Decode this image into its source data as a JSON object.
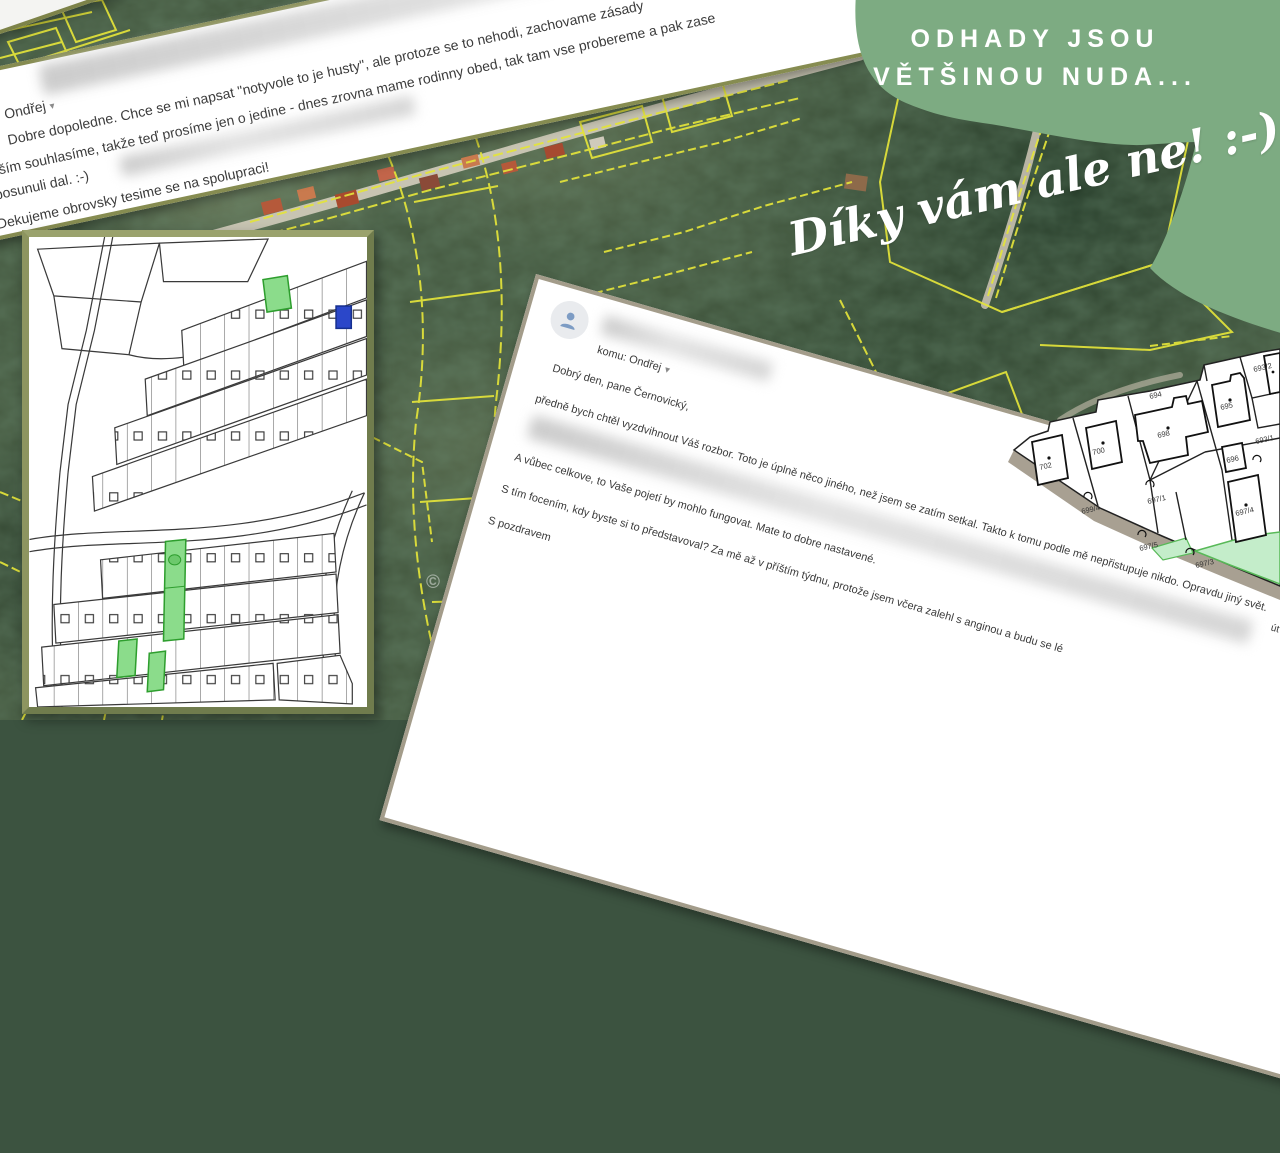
{
  "blob": {
    "title_line1": "ODHADY JSOU",
    "title_line2": "VĚTŠINOU NUDA...",
    "script_text": "Díky vám ale ne! :-)",
    "color": "#7dab82"
  },
  "email1": {
    "sender": "Ondřej",
    "dropdown_icon": "▾",
    "line1": "Dobre dopoledne. Chce se mi napsat \"notyvole to je husty\", ale protoze se to nehodi, zachovame zásady",
    "line2": "vším souhlasíme, takže teď prosíme jen o jedine - dnes zrovna mame rodinny obed, tak tam vse probereme a pak zase",
    "line3": "posunuli dal. :-)",
    "line4": "Dekujeme obrovsky tesime se na spolupraci!"
  },
  "email2": {
    "to_label": "komu: Ondřej",
    "dropdown_icon": "▾",
    "date": "út 7",
    "greeting": "Dobrý den, pane Černovický,",
    "para1": "předně bych chtěl vyzdvihnout Váš rozbor. Toto je úplně něco jiného, než jsem se zatím setkal. Takto k tomu podle mě nepřistupuje nikdo. Opravdu jiný svět.",
    "para2": "A vůbec celkove, to Vaše pojetí by mohlo fungovat. Mate to dobre nastavené.",
    "para3": "S tím focením, kdy byste si to představoval? Za mě až v příštím týdnu, protože jsem včera zalehl s anginou a budu se lé",
    "closing": "S pozdravem"
  },
  "map_fragment": {
    "parcels": [
      "702",
      "700",
      "698",
      "695",
      "696",
      "694",
      "693/2",
      "693/1",
      "699/4",
      "697/1",
      "697/5",
      "697/4",
      "697/3"
    ]
  },
  "map_overview": {
    "highlight_fill": "#8bdc8b",
    "highlight_stroke": "#2e9e2e",
    "marker_blue": "#2b47c9"
  },
  "satellite": {
    "watermark": "© ČÚZK",
    "parcel_line_color": "#e4e43a",
    "highlight_parcel_color": "#3ae24e"
  }
}
